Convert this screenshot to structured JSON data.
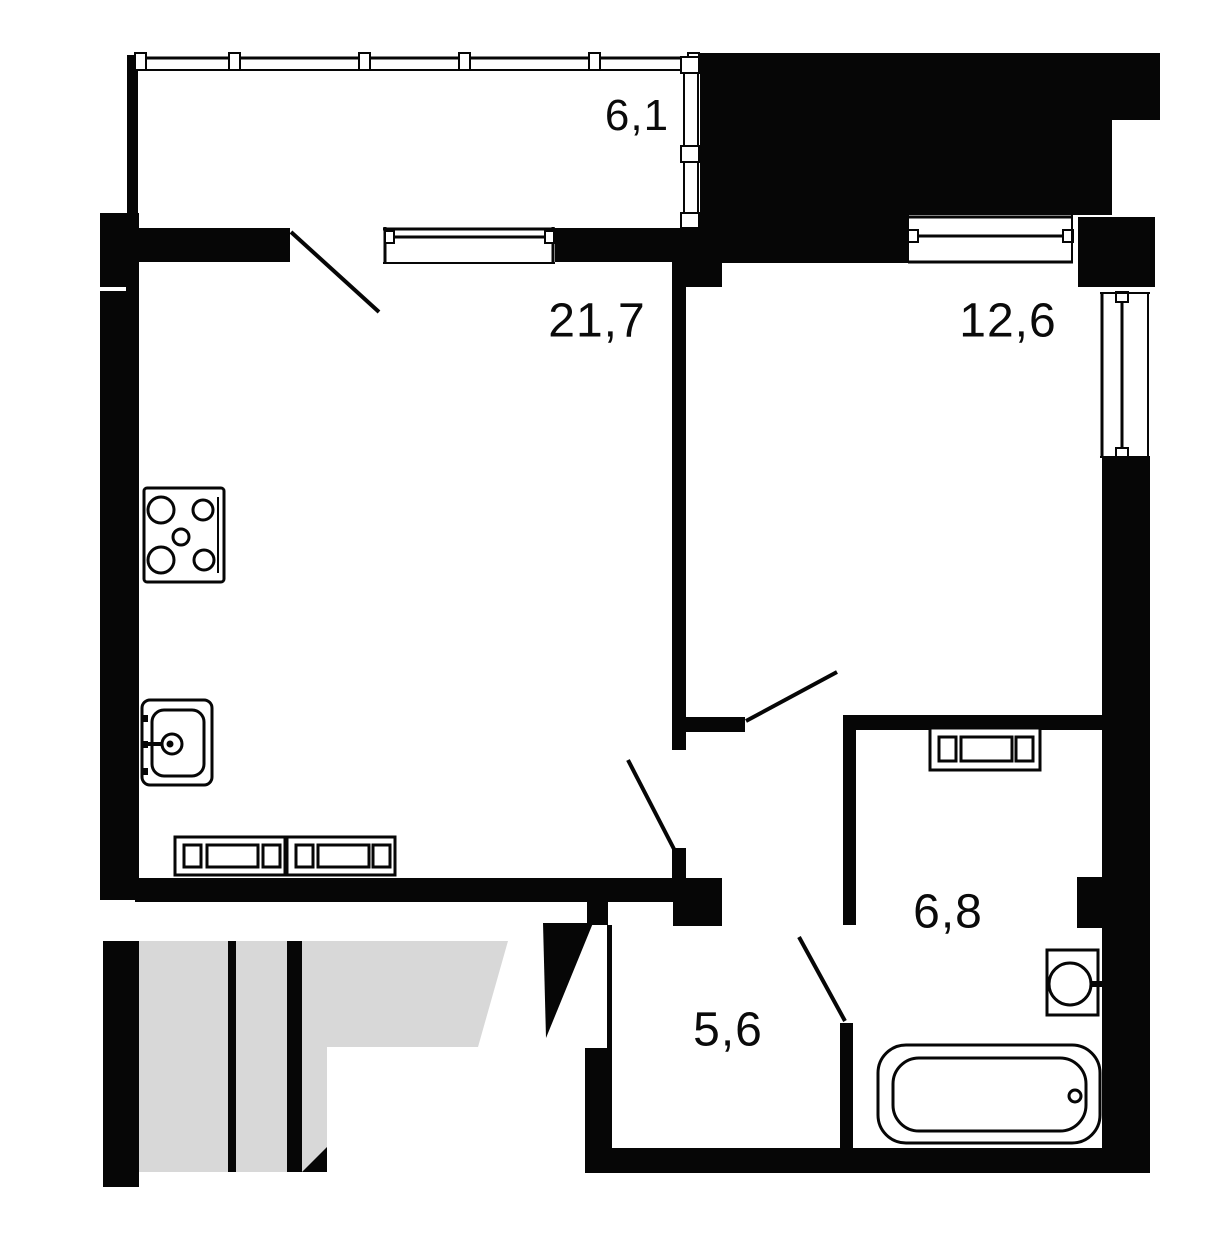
{
  "title": "apartment-floor-plan",
  "canvas": {
    "width": 1232,
    "height": 1250
  },
  "colors": {
    "wall": "#060606",
    "background": "#ffffff",
    "stairwell_fill": "#d8d8d8",
    "label_text": "#0a0a0a"
  },
  "rooms": [
    {
      "id": "balcony",
      "area_label": "6,1",
      "center": {
        "x": 637,
        "y": 116
      }
    },
    {
      "id": "living-kitchen",
      "area_label": "21,7",
      "center": {
        "x": 597,
        "y": 321
      }
    },
    {
      "id": "bedroom",
      "area_label": "12,6",
      "center": {
        "x": 1008,
        "y": 321
      }
    },
    {
      "id": "bathroom",
      "area_label": "6,8",
      "center": {
        "x": 948,
        "y": 912
      }
    },
    {
      "id": "hallway",
      "area_label": "5,6",
      "center": {
        "x": 728,
        "y": 1030
      }
    }
  ],
  "geometry": {
    "shapes": [
      {
        "k": "polygon",
        "n": "stairwell-floor",
        "pts": "139,941 508,941 478,1047 327,1047 327,1172 139,1172",
        "f": "#d8d8d8"
      },
      {
        "k": "rect",
        "n": "stairwell-left-wall",
        "x": 103,
        "y": 941,
        "w": 36,
        "h": 246,
        "f": "#060606"
      },
      {
        "k": "rect",
        "n": "stairwell-step-divider-thin",
        "x": 228,
        "y": 941,
        "w": 8,
        "h": 231,
        "f": "#060606"
      },
      {
        "k": "rect",
        "n": "stairwell-step-divider-thick",
        "x": 287,
        "y": 941,
        "w": 15,
        "h": 231,
        "f": "#060606"
      },
      {
        "k": "polygon",
        "n": "stairwell-corner-wedge",
        "pts": "327,1147 327,1172 302,1172",
        "f": "#060606"
      },
      {
        "k": "rect",
        "n": "left-wall",
        "x": 100,
        "y": 213,
        "w": 39,
        "h": 687,
        "f": "#060606"
      },
      {
        "k": "rect",
        "n": "left-wall-joint-line",
        "x": 100,
        "y": 287,
        "w": 26,
        "h": 4,
        "f": "#ffffff"
      },
      {
        "k": "rect",
        "n": "balcony-left-wall",
        "x": 127,
        "y": 55,
        "w": 11,
        "h": 160,
        "f": "#060606"
      },
      {
        "k": "rect",
        "n": "neighbor-block",
        "x": 700,
        "y": 53,
        "w": 412,
        "h": 162,
        "f": "#060606"
      },
      {
        "k": "rect",
        "n": "neighbor-block-extension",
        "x": 1112,
        "y": 53,
        "w": 48,
        "h": 67,
        "f": "#060606"
      },
      {
        "k": "rect",
        "n": "bedroom-top-wall",
        "x": 700,
        "y": 215,
        "w": 208,
        "h": 48,
        "f": "#060606"
      },
      {
        "k": "rect",
        "n": "top-right-pillar",
        "x": 1078,
        "y": 217,
        "w": 77,
        "h": 70,
        "f": "#060606"
      },
      {
        "k": "rect",
        "n": "right-wall",
        "x": 1102,
        "y": 458,
        "w": 48,
        "h": 715,
        "f": "#060606"
      },
      {
        "k": "rect",
        "n": "bathroom-vent-block",
        "x": 1077,
        "y": 877,
        "w": 51,
        "h": 51,
        "f": "#060606"
      },
      {
        "k": "rect",
        "n": "balcony-sill-wall-left",
        "x": 139,
        "y": 228,
        "w": 151,
        "h": 34,
        "f": "#060606"
      },
      {
        "k": "rect",
        "n": "balcony-sill-wall-right",
        "x": 555,
        "y": 228,
        "w": 118,
        "h": 34,
        "f": "#060606"
      },
      {
        "k": "rect",
        "n": "partition-top-block",
        "x": 672,
        "y": 228,
        "w": 50,
        "h": 59,
        "f": "#060606"
      },
      {
        "k": "rect",
        "n": "living-bedroom-partition",
        "x": 672,
        "y": 287,
        "w": 14,
        "h": 463,
        "f": "#060606"
      },
      {
        "k": "rect",
        "n": "bedroom-door-stub",
        "x": 682,
        "y": 717,
        "w": 63,
        "h": 15,
        "f": "#060606"
      },
      {
        "k": "rect",
        "n": "living-door-stub",
        "x": 672,
        "y": 848,
        "w": 14,
        "h": 30,
        "f": "#060606"
      },
      {
        "k": "rect",
        "n": "living-bottom-wall",
        "x": 135,
        "y": 878,
        "w": 538,
        "h": 24,
        "f": "#060606"
      },
      {
        "k": "rect",
        "n": "hall-top-block",
        "x": 673,
        "y": 878,
        "w": 49,
        "h": 48,
        "f": "#060606"
      },
      {
        "k": "rect",
        "n": "entry-door-jamb",
        "x": 587,
        "y": 902,
        "w": 21,
        "h": 23,
        "f": "#060606"
      },
      {
        "k": "rect",
        "n": "hall-left-thin-wall",
        "x": 607,
        "y": 925,
        "w": 5,
        "h": 123,
        "f": "#060606"
      },
      {
        "k": "rect",
        "n": "hall-left-wall",
        "x": 585,
        "y": 1048,
        "w": 27,
        "h": 100,
        "f": "#060606"
      },
      {
        "k": "rect",
        "n": "bottom-wall",
        "x": 585,
        "y": 1148,
        "w": 565,
        "h": 25,
        "f": "#060606"
      },
      {
        "k": "rect",
        "n": "bathroom-top-wall",
        "x": 843,
        "y": 715,
        "w": 259,
        "h": 15,
        "f": "#060606"
      },
      {
        "k": "rect",
        "n": "bathroom-left-wall-upper",
        "x": 843,
        "y": 730,
        "w": 13,
        "h": 195,
        "f": "#060606"
      },
      {
        "k": "rect",
        "n": "bathroom-left-wall-lower",
        "x": 840,
        "y": 1023,
        "w": 13,
        "h": 125,
        "f": "#060606"
      },
      {
        "k": "line",
        "n": "balcony-glazing-top-line",
        "x1": 135,
        "y1": 58,
        "x2": 700,
        "y2": 58,
        "sw": 3
      },
      {
        "k": "line",
        "n": "balcony-glazing-bottom-line",
        "x1": 135,
        "y1": 70,
        "x2": 700,
        "y2": 70,
        "sw": 2
      },
      {
        "k": "rect",
        "n": "balcony-glazing-mullion",
        "x": 135,
        "y": 53,
        "w": 11,
        "h": 17,
        "f": "#ffffff",
        "s": "#060606",
        "sw": 2
      },
      {
        "k": "rect",
        "n": "balcony-glazing-mullion",
        "x": 229,
        "y": 53,
        "w": 11,
        "h": 17,
        "f": "#ffffff",
        "s": "#060606",
        "sw": 2
      },
      {
        "k": "rect",
        "n": "balcony-glazing-mullion",
        "x": 359,
        "y": 53,
        "w": 11,
        "h": 17,
        "f": "#ffffff",
        "s": "#060606",
        "sw": 2
      },
      {
        "k": "rect",
        "n": "balcony-glazing-mullion",
        "x": 459,
        "y": 53,
        "w": 11,
        "h": 17,
        "f": "#ffffff",
        "s": "#060606",
        "sw": 2
      },
      {
        "k": "rect",
        "n": "balcony-glazing-mullion",
        "x": 589,
        "y": 53,
        "w": 11,
        "h": 17,
        "f": "#ffffff",
        "s": "#060606",
        "sw": 2
      },
      {
        "k": "rect",
        "n": "balcony-glazing-mullion",
        "x": 688,
        "y": 53,
        "w": 11,
        "h": 17,
        "f": "#ffffff",
        "s": "#060606",
        "sw": 2
      },
      {
        "k": "line",
        "n": "balcony-side-glazing-left-line",
        "x1": 684,
        "y1": 57,
        "x2": 684,
        "y2": 230,
        "sw": 2
      },
      {
        "k": "line",
        "n": "balcony-side-glazing-right-line",
        "x1": 698,
        "y1": 57,
        "x2": 698,
        "y2": 230,
        "sw": 2
      },
      {
        "k": "rect",
        "n": "balcony-side-glazing-mullion",
        "x": 681,
        "y": 57,
        "w": 18,
        "h": 16,
        "f": "#ffffff",
        "s": "#060606",
        "sw": 2
      },
      {
        "k": "rect",
        "n": "balcony-side-glazing-mullion",
        "x": 681,
        "y": 146,
        "w": 18,
        "h": 16,
        "f": "#ffffff",
        "s": "#060606",
        "sw": 2
      },
      {
        "k": "rect",
        "n": "balcony-side-glazing-mullion",
        "x": 681,
        "y": 213,
        "w": 18,
        "h": 15,
        "f": "#ffffff",
        "s": "#060606",
        "sw": 2
      },
      {
        "k": "line",
        "n": "living-balcony-window-jamb-left",
        "x1": 385,
        "y1": 227,
        "x2": 385,
        "y2": 264,
        "sw": 3
      },
      {
        "k": "line",
        "n": "living-balcony-window-jamb-right",
        "x1": 553,
        "y1": 227,
        "x2": 553,
        "y2": 264,
        "sw": 3
      },
      {
        "k": "line",
        "n": "living-balcony-window-top",
        "x1": 383,
        "y1": 229,
        "x2": 555,
        "y2": 229,
        "sw": 3
      },
      {
        "k": "line",
        "n": "living-balcony-window-glazing",
        "x1": 390,
        "y1": 237,
        "x2": 548,
        "y2": 237,
        "sw": 3
      },
      {
        "k": "rect",
        "n": "living-balcony-window-end",
        "x": 385,
        "y": 231,
        "w": 9,
        "h": 12,
        "f": "#ffffff",
        "s": "#060606",
        "sw": 2
      },
      {
        "k": "rect",
        "n": "living-balcony-window-end",
        "x": 545,
        "y": 231,
        "w": 9,
        "h": 12,
        "f": "#ffffff",
        "s": "#060606",
        "sw": 2
      },
      {
        "k": "line",
        "n": "living-balcony-window-sill",
        "x1": 383,
        "y1": 263,
        "x2": 555,
        "y2": 263,
        "sw": 2
      },
      {
        "k": "line",
        "n": "bedroom-window-top",
        "x1": 908,
        "y1": 217,
        "x2": 1073,
        "y2": 217,
        "sw": 3
      },
      {
        "k": "line",
        "n": "bedroom-window-glazing",
        "x1": 913,
        "y1": 236,
        "x2": 1068,
        "y2": 236,
        "sw": 3
      },
      {
        "k": "rect",
        "n": "bedroom-window-end",
        "x": 908,
        "y": 230,
        "w": 10,
        "h": 12,
        "f": "#ffffff",
        "s": "#060606",
        "sw": 2
      },
      {
        "k": "rect",
        "n": "bedroom-window-end",
        "x": 1063,
        "y": 230,
        "w": 10,
        "h": 12,
        "f": "#ffffff",
        "s": "#060606",
        "sw": 2
      },
      {
        "k": "line",
        "n": "bedroom-window-sill",
        "x1": 908,
        "y1": 262,
        "x2": 1073,
        "y2": 262,
        "sw": 3
      },
      {
        "k": "line",
        "n": "bedroom-window-side-left",
        "x1": 908,
        "y1": 215,
        "x2": 908,
        "y2": 263,
        "sw": 2
      },
      {
        "k": "line",
        "n": "bedroom-window-side-right",
        "x1": 1072,
        "y1": 215,
        "x2": 1072,
        "y2": 263,
        "sw": 2
      },
      {
        "k": "line",
        "n": "right-window-inner-line",
        "x1": 1102,
        "y1": 292,
        "x2": 1102,
        "y2": 458,
        "sw": 3
      },
      {
        "k": "line",
        "n": "right-window-outer-line",
        "x1": 1148,
        "y1": 292,
        "x2": 1148,
        "y2": 458,
        "sw": 2
      },
      {
        "k": "line",
        "n": "right-window-glazing",
        "x1": 1122,
        "y1": 298,
        "x2": 1122,
        "y2": 452,
        "sw": 3
      },
      {
        "k": "rect",
        "n": "right-window-end",
        "x": 1116,
        "y": 292,
        "w": 12,
        "h": 10,
        "f": "#ffffff",
        "s": "#060606",
        "sw": 2
      },
      {
        "k": "rect",
        "n": "right-window-end",
        "x": 1116,
        "y": 448,
        "w": 12,
        "h": 10,
        "f": "#ffffff",
        "s": "#060606",
        "sw": 2
      },
      {
        "k": "line",
        "n": "right-window-cap-top",
        "x1": 1100,
        "y1": 293,
        "x2": 1150,
        "y2": 293,
        "sw": 2
      },
      {
        "k": "line",
        "n": "right-window-cap-bottom",
        "x1": 1100,
        "y1": 457,
        "x2": 1150,
        "y2": 457,
        "sw": 2
      },
      {
        "k": "line",
        "n": "balcony-door-swing",
        "x1": 291,
        "y1": 232,
        "x2": 379,
        "y2": 312,
        "sw": 4
      },
      {
        "k": "line",
        "n": "living-door-swing",
        "x1": 628,
        "y1": 760,
        "x2": 675,
        "y2": 851,
        "sw": 4
      },
      {
        "k": "line",
        "n": "bedroom-door-swing",
        "x1": 746,
        "y1": 721,
        "x2": 837,
        "y2": 672,
        "sw": 4
      },
      {
        "k": "line",
        "n": "bathroom-door-swing",
        "x1": 799,
        "y1": 937,
        "x2": 845,
        "y2": 1021,
        "sw": 4
      },
      {
        "k": "polygon",
        "n": "entrance-door-leaf",
        "pts": "543,923 593,923 546,1038",
        "f": "#060606"
      },
      {
        "k": "rect",
        "n": "stove-body",
        "x": 144,
        "y": 488,
        "w": 80,
        "h": 94,
        "rx": 3,
        "f": "#ffffff",
        "s": "#060606",
        "sw": 3
      },
      {
        "k": "line",
        "n": "stove-handle",
        "x1": 218,
        "y1": 497,
        "x2": 218,
        "y2": 573,
        "sw": 2
      },
      {
        "k": "circle",
        "n": "stove-burner-large",
        "cx": 161,
        "cy": 510,
        "r": 13,
        "f": "none",
        "s": "#060606",
        "sw": 3
      },
      {
        "k": "circle",
        "n": "stove-burner-small",
        "cx": 203,
        "cy": 510,
        "r": 10,
        "f": "none",
        "s": "#060606",
        "sw": 3
      },
      {
        "k": "circle",
        "n": "stove-burner-center",
        "cx": 181,
        "cy": 537,
        "r": 8,
        "f": "none",
        "s": "#060606",
        "sw": 3
      },
      {
        "k": "circle",
        "n": "stove-burner-large",
        "cx": 161,
        "cy": 560,
        "r": 13,
        "f": "none",
        "s": "#060606",
        "sw": 3
      },
      {
        "k": "circle",
        "n": "stove-burner-small",
        "cx": 204,
        "cy": 560,
        "r": 10,
        "f": "none",
        "s": "#060606",
        "sw": 3
      },
      {
        "k": "rect",
        "n": "sink-body",
        "x": 142,
        "y": 700,
        "w": 70,
        "h": 85,
        "rx": 8,
        "f": "#ffffff",
        "s": "#060606",
        "sw": 3
      },
      {
        "k": "rect",
        "n": "sink-basin",
        "x": 152,
        "y": 710,
        "w": 52,
        "h": 66,
        "rx": 12,
        "f": "none",
        "s": "#060606",
        "sw": 3
      },
      {
        "k": "rect",
        "n": "sink-hinge",
        "x": 143,
        "y": 715,
        "w": 5,
        "h": 7,
        "f": "#060606"
      },
      {
        "k": "rect",
        "n": "sink-hinge",
        "x": 143,
        "y": 741,
        "w": 5,
        "h": 7,
        "f": "#060606"
      },
      {
        "k": "rect",
        "n": "sink-hinge",
        "x": 143,
        "y": 768,
        "w": 5,
        "h": 7,
        "f": "#060606"
      },
      {
        "k": "line",
        "n": "sink-faucet-arm",
        "x1": 142,
        "y1": 744,
        "x2": 164,
        "y2": 744,
        "sw": 4
      },
      {
        "k": "circle",
        "n": "sink-faucet-ring",
        "cx": 172,
        "cy": 744,
        "r": 10,
        "f": "#ffffff",
        "s": "#060606",
        "sw": 3
      },
      {
        "k": "circle",
        "n": "sink-faucet-dot",
        "cx": 170,
        "cy": 744,
        "r": 3.5,
        "f": "#060606"
      },
      {
        "k": "rect",
        "n": "kitchen-radiator-body",
        "x": 175,
        "y": 837,
        "w": 110,
        "h": 38,
        "f": "#ffffff",
        "s": "#060606",
        "sw": 3
      },
      {
        "k": "rect",
        "n": "kitchen-radiator-cell",
        "x": 184,
        "y": 845,
        "w": 17,
        "h": 22,
        "f": "none",
        "s": "#060606",
        "sw": 3
      },
      {
        "k": "rect",
        "n": "kitchen-radiator-cell-long",
        "x": 207,
        "y": 845,
        "w": 51,
        "h": 22,
        "f": "none",
        "s": "#060606",
        "sw": 3
      },
      {
        "k": "rect",
        "n": "kitchen-radiator-cell",
        "x": 263,
        "y": 845,
        "w": 17,
        "h": 22,
        "f": "none",
        "s": "#060606",
        "sw": 3
      },
      {
        "k": "rect",
        "n": "kitchen-radiator-body",
        "x": 287,
        "y": 837,
        "w": 108,
        "h": 38,
        "f": "#ffffff",
        "s": "#060606",
        "sw": 3
      },
      {
        "k": "rect",
        "n": "kitchen-radiator-cell",
        "x": 296,
        "y": 845,
        "w": 17,
        "h": 22,
        "f": "none",
        "s": "#060606",
        "sw": 3
      },
      {
        "k": "rect",
        "n": "kitchen-radiator-cell-long",
        "x": 318,
        "y": 845,
        "w": 51,
        "h": 22,
        "f": "none",
        "s": "#060606",
        "sw": 3
      },
      {
        "k": "rect",
        "n": "kitchen-radiator-cell",
        "x": 373,
        "y": 845,
        "w": 17,
        "h": 22,
        "f": "none",
        "s": "#060606",
        "sw": 3
      },
      {
        "k": "rect",
        "n": "towel-radiator-body",
        "x": 930,
        "y": 728,
        "w": 110,
        "h": 42,
        "f": "#ffffff",
        "s": "#060606",
        "sw": 3
      },
      {
        "k": "rect",
        "n": "towel-radiator-cell",
        "x": 939,
        "y": 737,
        "w": 17,
        "h": 24,
        "f": "none",
        "s": "#060606",
        "sw": 3
      },
      {
        "k": "rect",
        "n": "towel-radiator-cell-long",
        "x": 961,
        "y": 737,
        "w": 51,
        "h": 24,
        "f": "none",
        "s": "#060606",
        "sw": 3
      },
      {
        "k": "rect",
        "n": "towel-radiator-cell",
        "x": 1016,
        "y": 737,
        "w": 17,
        "h": 24,
        "f": "none",
        "s": "#060606",
        "sw": 3
      },
      {
        "k": "rect",
        "n": "washbasin-body",
        "x": 1047,
        "y": 950,
        "w": 51,
        "h": 65,
        "f": "#ffffff",
        "s": "#060606",
        "sw": 3
      },
      {
        "k": "circle",
        "n": "washbasin-bowl",
        "cx": 1070,
        "cy": 984,
        "r": 21,
        "f": "none",
        "s": "#060606",
        "sw": 3
      },
      {
        "k": "line",
        "n": "washbasin-tap",
        "x1": 1090,
        "y1": 984,
        "x2": 1103,
        "y2": 984,
        "sw": 6
      },
      {
        "k": "rect",
        "n": "bathtub-outer",
        "x": 878,
        "y": 1045,
        "w": 222,
        "h": 98,
        "rx": 28,
        "f": "#ffffff",
        "s": "#060606",
        "sw": 3
      },
      {
        "k": "rect",
        "n": "bathtub-inner",
        "x": 893,
        "y": 1058,
        "w": 193,
        "h": 73,
        "rx": 26,
        "f": "none",
        "s": "#060606",
        "sw": 3
      },
      {
        "k": "circle",
        "n": "bathtub-drain",
        "cx": 1075,
        "cy": 1096,
        "r": 6,
        "f": "#ffffff",
        "s": "#060606",
        "sw": 3
      }
    ]
  }
}
